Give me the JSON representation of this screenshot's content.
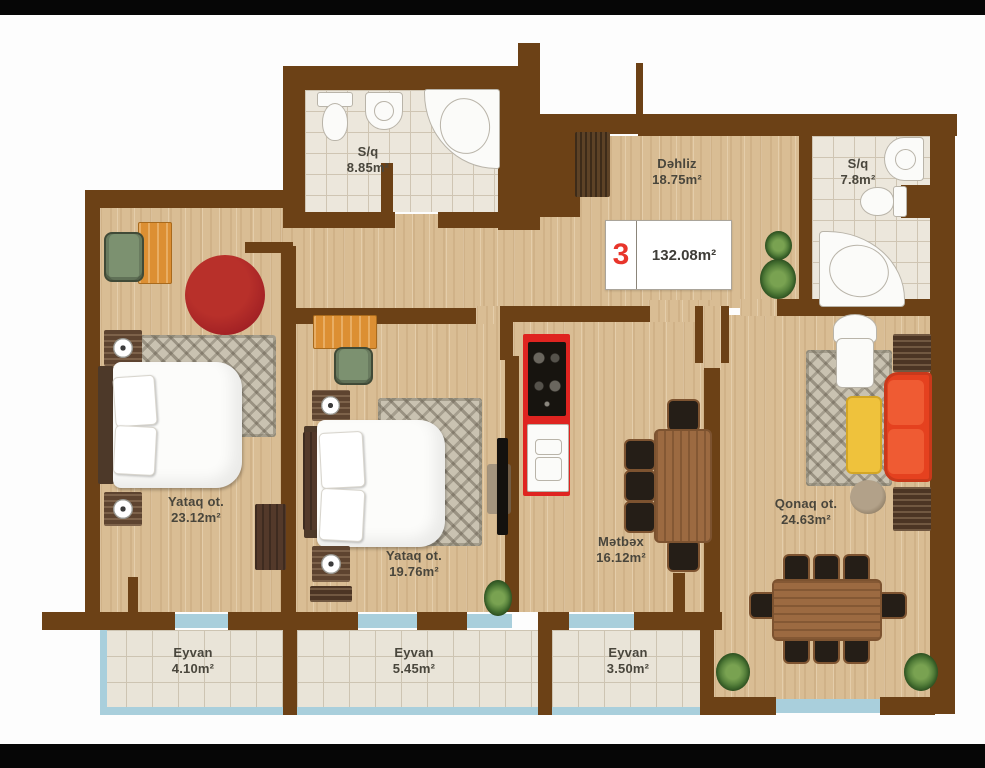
{
  "unit": {
    "number": "3",
    "total_area": "132.08m²"
  },
  "rooms": {
    "hallway": {
      "name": "Dəhliz",
      "area": "18.75m²"
    },
    "bath_top": {
      "name": "S/q",
      "area": "8.85m²"
    },
    "bath_right": {
      "name": "S/q",
      "area": "7.8m²"
    },
    "bedroom_left": {
      "name": "Yataq ot.",
      "area": "23.12m²"
    },
    "bedroom_mid": {
      "name": "Yataq ot.",
      "area": "19.76m²"
    },
    "kitchen": {
      "name": "Mətbəx",
      "area": "16.12m²"
    },
    "living": {
      "name": "Qonaq ot.",
      "area": "24.63m²"
    },
    "balcony_left": {
      "name": "Eyvan",
      "area": "4.10m²"
    },
    "balcony_mid": {
      "name": "Eyvan",
      "area": "5.45m²"
    },
    "balcony_right": {
      "name": "Eyvan",
      "area": "3.50m²"
    }
  },
  "colors": {
    "wall": "#6c4116",
    "floor_wood": "#d9bd94",
    "tile": "#ece7dc",
    "balcony_glass": "#a9cfdc",
    "unit_number_red": "#e8352b",
    "sofa_red": "#e5411f",
    "kitchen_unit_red": "#df2420",
    "coffee_table_yellow": "#efc23c",
    "plant_green": "#477232"
  }
}
